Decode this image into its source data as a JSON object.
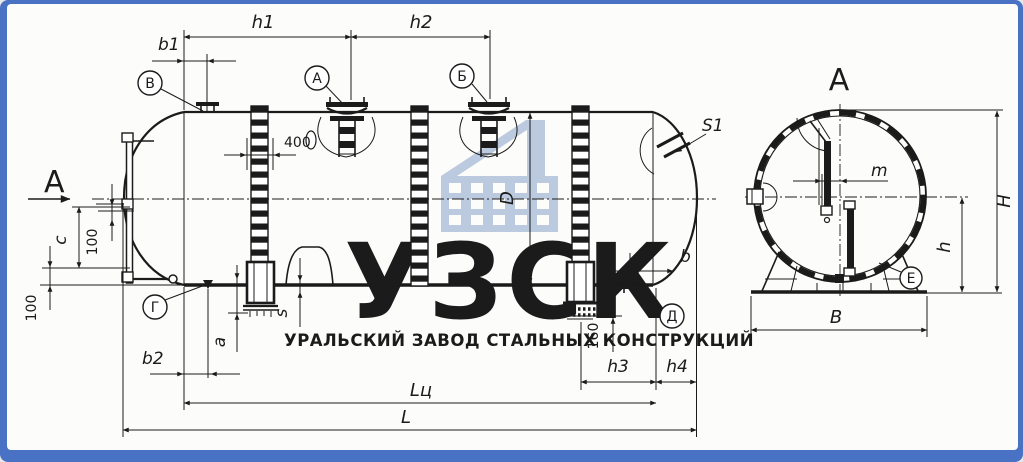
{
  "colors": {
    "frame": "#4a72c4",
    "paper": "#fcfcfa",
    "line": "#1b1b1b",
    "watermark_logo": "#b5c1d8",
    "watermark_tagline": "#a5b9da",
    "watermark_icon": "#bccadf"
  },
  "watermark": {
    "logo": "УЗСК",
    "tagline": "УРАЛЬСКИЙ ЗАВОД СТАЛЬНЫХ КОНСТРУКЦИЙ"
  },
  "side_view": {
    "section_label": "А",
    "dims": {
      "h1": "h1",
      "h2": "h2",
      "b1": "b1",
      "manhole_offset": "400",
      "diameter": "D",
      "gauge_c": "c",
      "gauge_100_top": "100",
      "gauge_100_bottom": "100",
      "b2": "b2",
      "a": "a",
      "wall": "s",
      "head_wall": "S1",
      "flange_drop": "160",
      "b": "b",
      "h3": "h3",
      "h4": "h4",
      "cylinder_length": "Lц",
      "overall_length": "L"
    },
    "callouts": {
      "top_nozzle": "В",
      "manhole_1": "А",
      "manhole_2": "Б",
      "bottom_left": "Г",
      "bottom_right": "Д"
    }
  },
  "section_view": {
    "title": "А",
    "callout_support": "Е",
    "dims": {
      "m": "m",
      "overall_height": "H",
      "axis_height": "h",
      "base_width": "B"
    }
  }
}
